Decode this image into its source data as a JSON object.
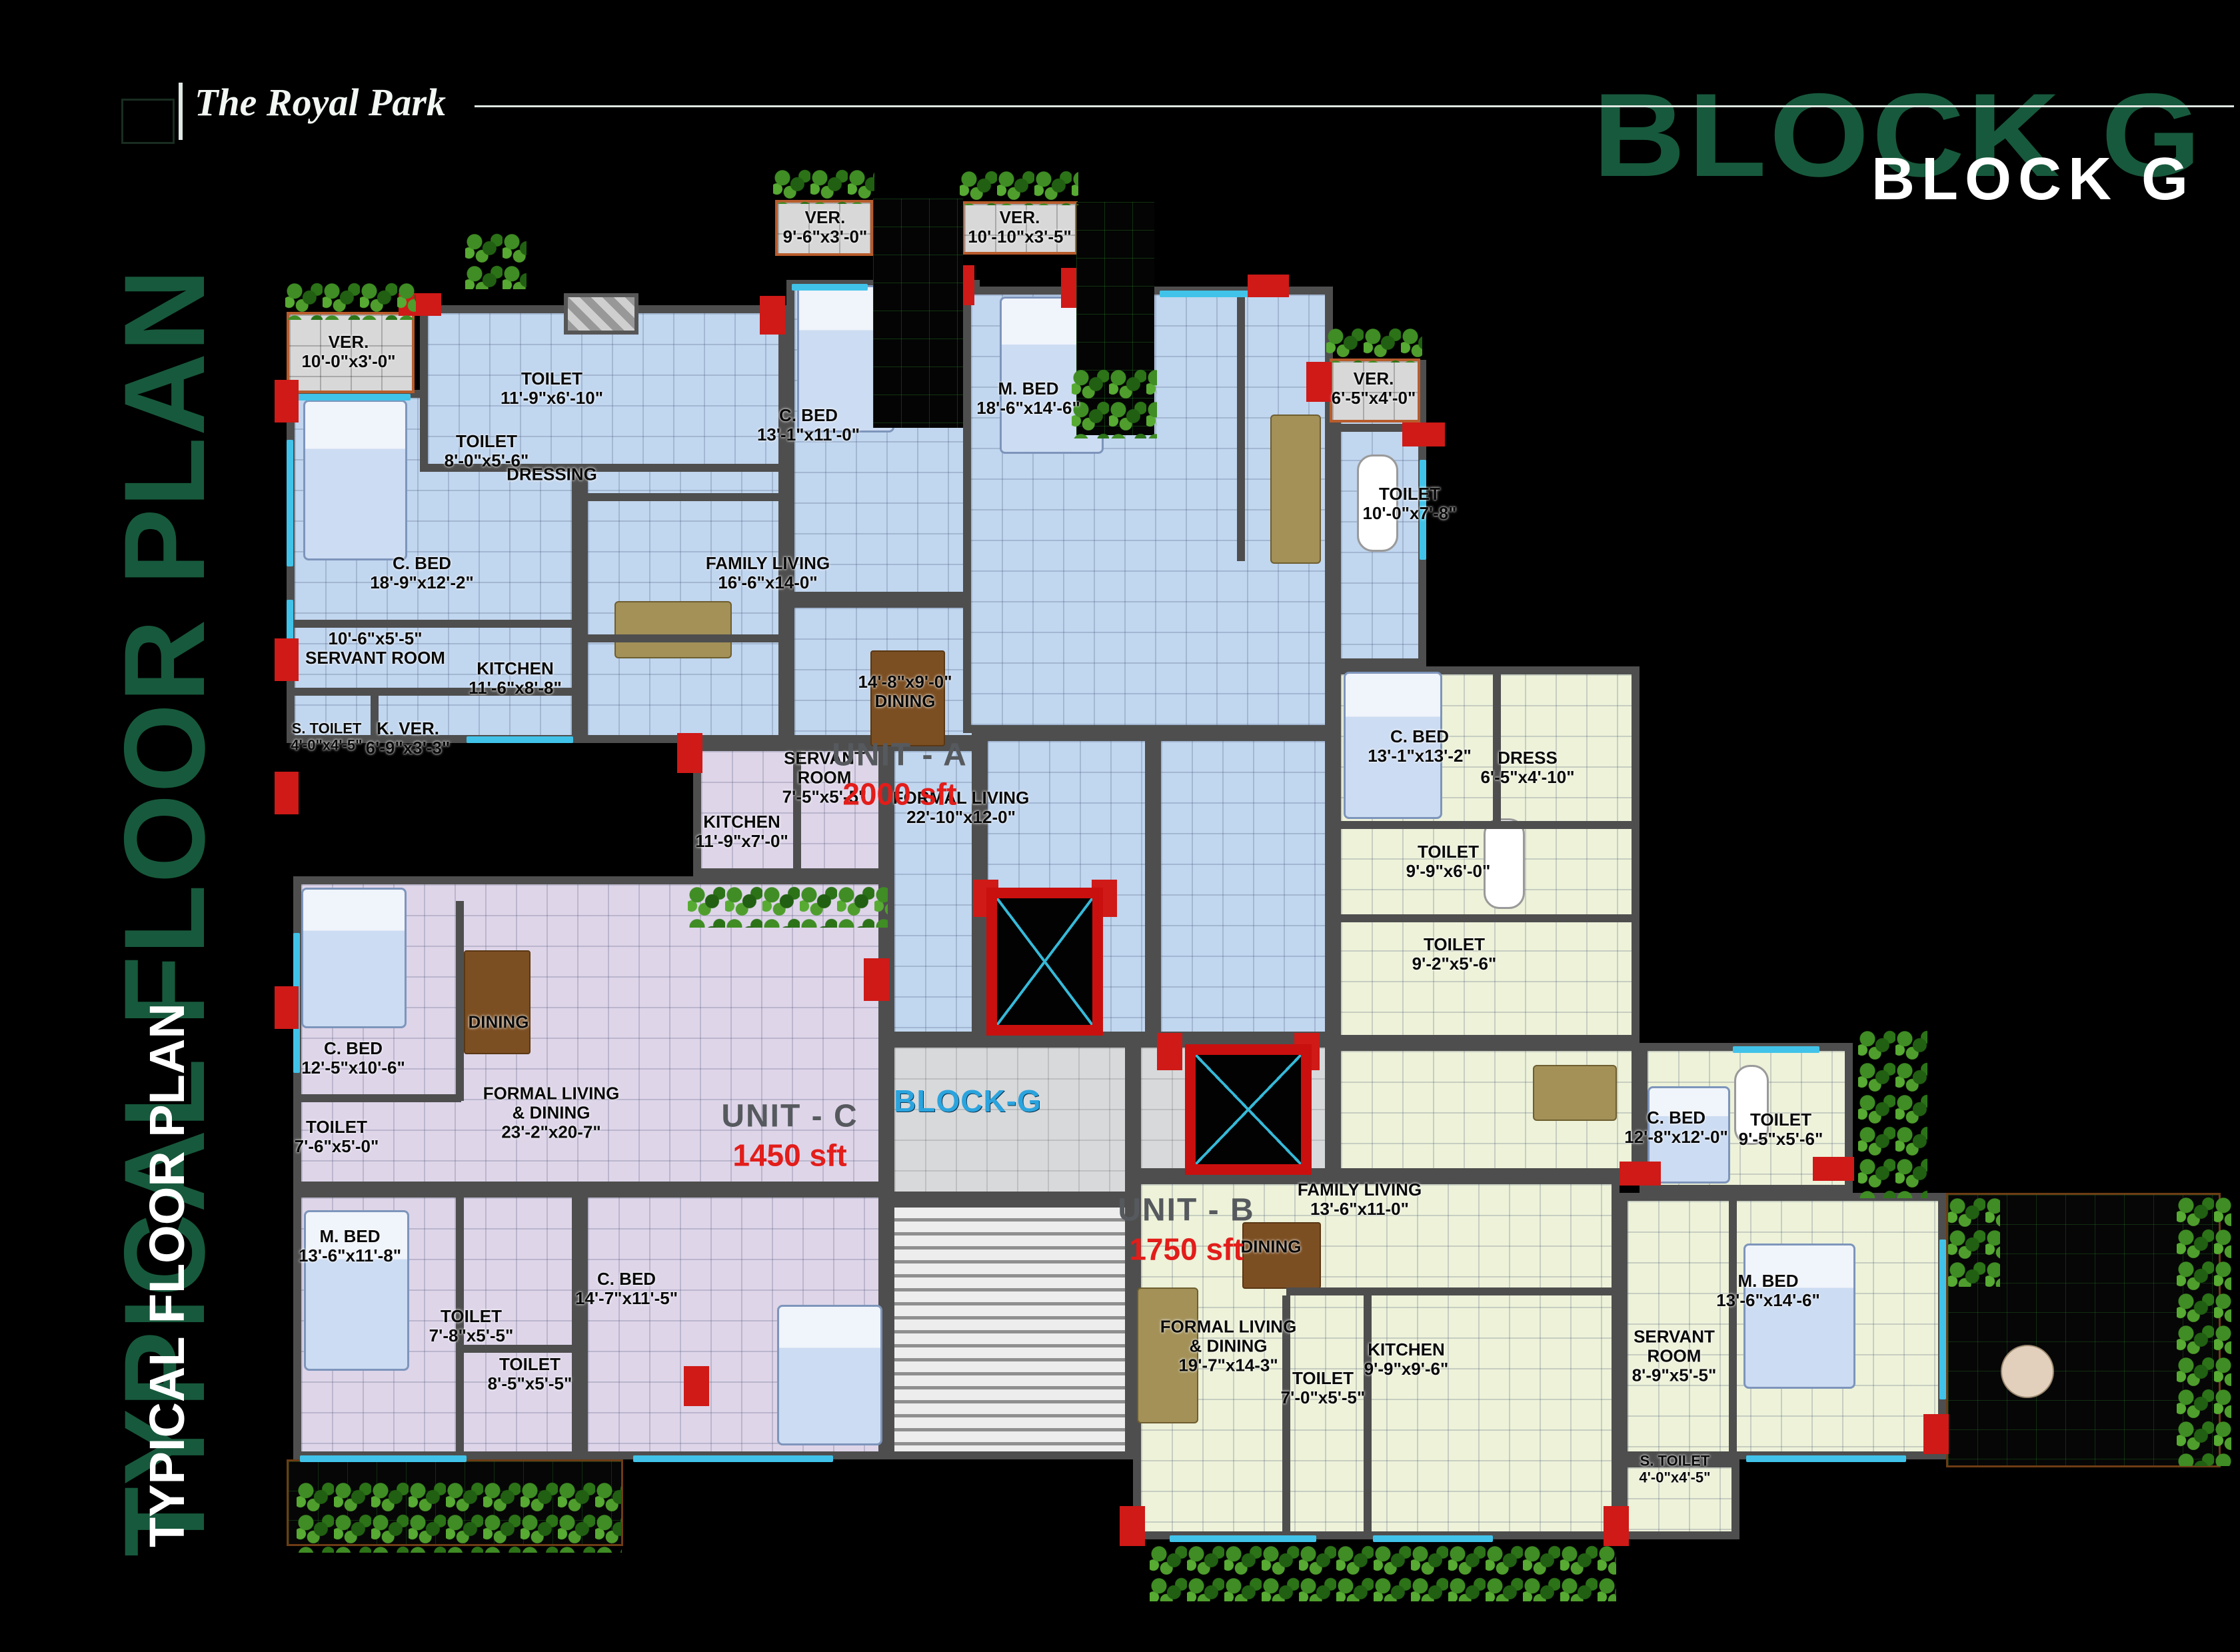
{
  "brand": {
    "logo_text": "The Royal Park"
  },
  "header": {
    "block_title_back": "BLOCK G",
    "block_title_front": "BLOCK G"
  },
  "side_title": {
    "back": "TYPICAL FLOOR PLAN",
    "front": "TYPICAL FLOOR PLAN"
  },
  "core": {
    "block_label": "BLOCK-G"
  },
  "colors": {
    "unit_a_floor": "#c1d6ef",
    "unit_b_floor": "#edf2d9",
    "unit_c_floor": "#ded5e9",
    "wall": "#4e4e4e",
    "accent_column_red": "#cf1a17",
    "window_cyan": "#41c3e9",
    "title_green": "#17593c",
    "block_label_blue": "#2aa4de",
    "area_red": "#e21d1a"
  },
  "units": {
    "a": {
      "label": "UNIT - A",
      "area": "2000 sft",
      "rooms": [
        {
          "l1": "VER.",
          "l2": "10'-0\"x3'-0\""
        },
        {
          "l1": "TOILET",
          "l2": "11'-9\"x6'-10\""
        },
        {
          "l1": "TOILET",
          "l2": "8'-0\"x5'-6\""
        },
        {
          "l1": "DRESSING"
        },
        {
          "l1": "C. BED",
          "l2": "18'-9\"x12'-2\""
        },
        {
          "l1": "VER.",
          "l2": "9'-6\"x3'-0\""
        },
        {
          "l1": "C. BED",
          "l2": "13'-1\"x11'-0\""
        },
        {
          "l1": "FAMILY LIVING",
          "l2": "16'-6\"x14-0\""
        },
        {
          "l1": "10'-6\"x5'-5\"",
          "l2": "SERVANT ROOM"
        },
        {
          "l1": "KITCHEN",
          "l2": "11'-6\"x8'-8\""
        },
        {
          "l1": "S. TOILET",
          "l2": "4'-0\"x4'-5\""
        },
        {
          "l1": "K. VER.",
          "l2": "6'-9\"x3'-3\""
        },
        {
          "l1": "VER.",
          "l2": "10'-10\"x3'-5\""
        },
        {
          "l1": "M. BED",
          "l2": "18'-6\"x14'-6\""
        },
        {
          "l1": "VER.",
          "l2": "6'-5\"x4'-0\""
        },
        {
          "l1": "TOILET",
          "l2": "10'-0\"x7'-8\""
        },
        {
          "l1": "14'-8\"x9'-0\"",
          "l2": "DINING"
        },
        {
          "l1": "FORMAL LIVING",
          "l2": "22'-10\"x12-0\""
        },
        {
          "l1": "SERVANT",
          "l2": "ROOM",
          "l3": "7'-5\"x5'-5\""
        }
      ]
    },
    "c": {
      "label": "UNIT - C",
      "area": "1450 sft",
      "rooms": [
        {
          "l1": "KITCHEN",
          "l2": "11'-9\"x7'-0\""
        },
        {
          "l1": "C. BED",
          "l2": "12'-5\"x10'-6\""
        },
        {
          "l1": "DINING"
        },
        {
          "l1": "FORMAL LIVING",
          "l2": "&    DINING",
          "l3": "23'-2\"x20-7\""
        },
        {
          "l1": "TOILET",
          "l2": "7'-6\"x5'-0\""
        },
        {
          "l1": "M. BED",
          "l2": "13'-6\"x11'-8\""
        },
        {
          "l1": "TOILET",
          "l2": "7'-8\"x5'-5\""
        },
        {
          "l1": "TOILET",
          "l2": "8'-5\"x5'-5\""
        },
        {
          "l1": "C. BED",
          "l2": "14'-7\"x11'-5\""
        }
      ]
    },
    "b": {
      "label": "UNIT - B",
      "area": "1750 sft",
      "rooms": [
        {
          "l1": "C. BED",
          "l2": "13'-1\"x13'-2\""
        },
        {
          "l1": "DRESS",
          "l2": "6'-5\"x4'-10\""
        },
        {
          "l1": "TOILET",
          "l2": "9'-9\"x6'-0\""
        },
        {
          "l1": "TOILET",
          "l2": "9'-2\"x5'-6\""
        },
        {
          "l1": "C. BED",
          "l2": "12'-8\"x12'-0\""
        },
        {
          "l1": "TOILET",
          "l2": "9'-5\"x5'-6\""
        },
        {
          "l1": "FAMILY LIVING",
          "l2": "13'-6\"x11-0\""
        },
        {
          "l1": "DINING"
        },
        {
          "l1": "FORMAL LIVING",
          "l2": "&    DINING",
          "l3": "19'-7\"x14-3\""
        },
        {
          "l1": "TOILET",
          "l2": "7'-0\"x5'-5\""
        },
        {
          "l1": "KITCHEN",
          "l2": "9'-9\"x9'-6\""
        },
        {
          "l1": "SERVANT",
          "l2": "ROOM",
          "l3": "8'-9\"x5'-5\""
        },
        {
          "l1": "M. BED",
          "l2": "13'-6\"x14'-6\""
        },
        {
          "l1": "S. TOILET",
          "l2": "4'-0\"x4'-5\""
        }
      ]
    }
  }
}
